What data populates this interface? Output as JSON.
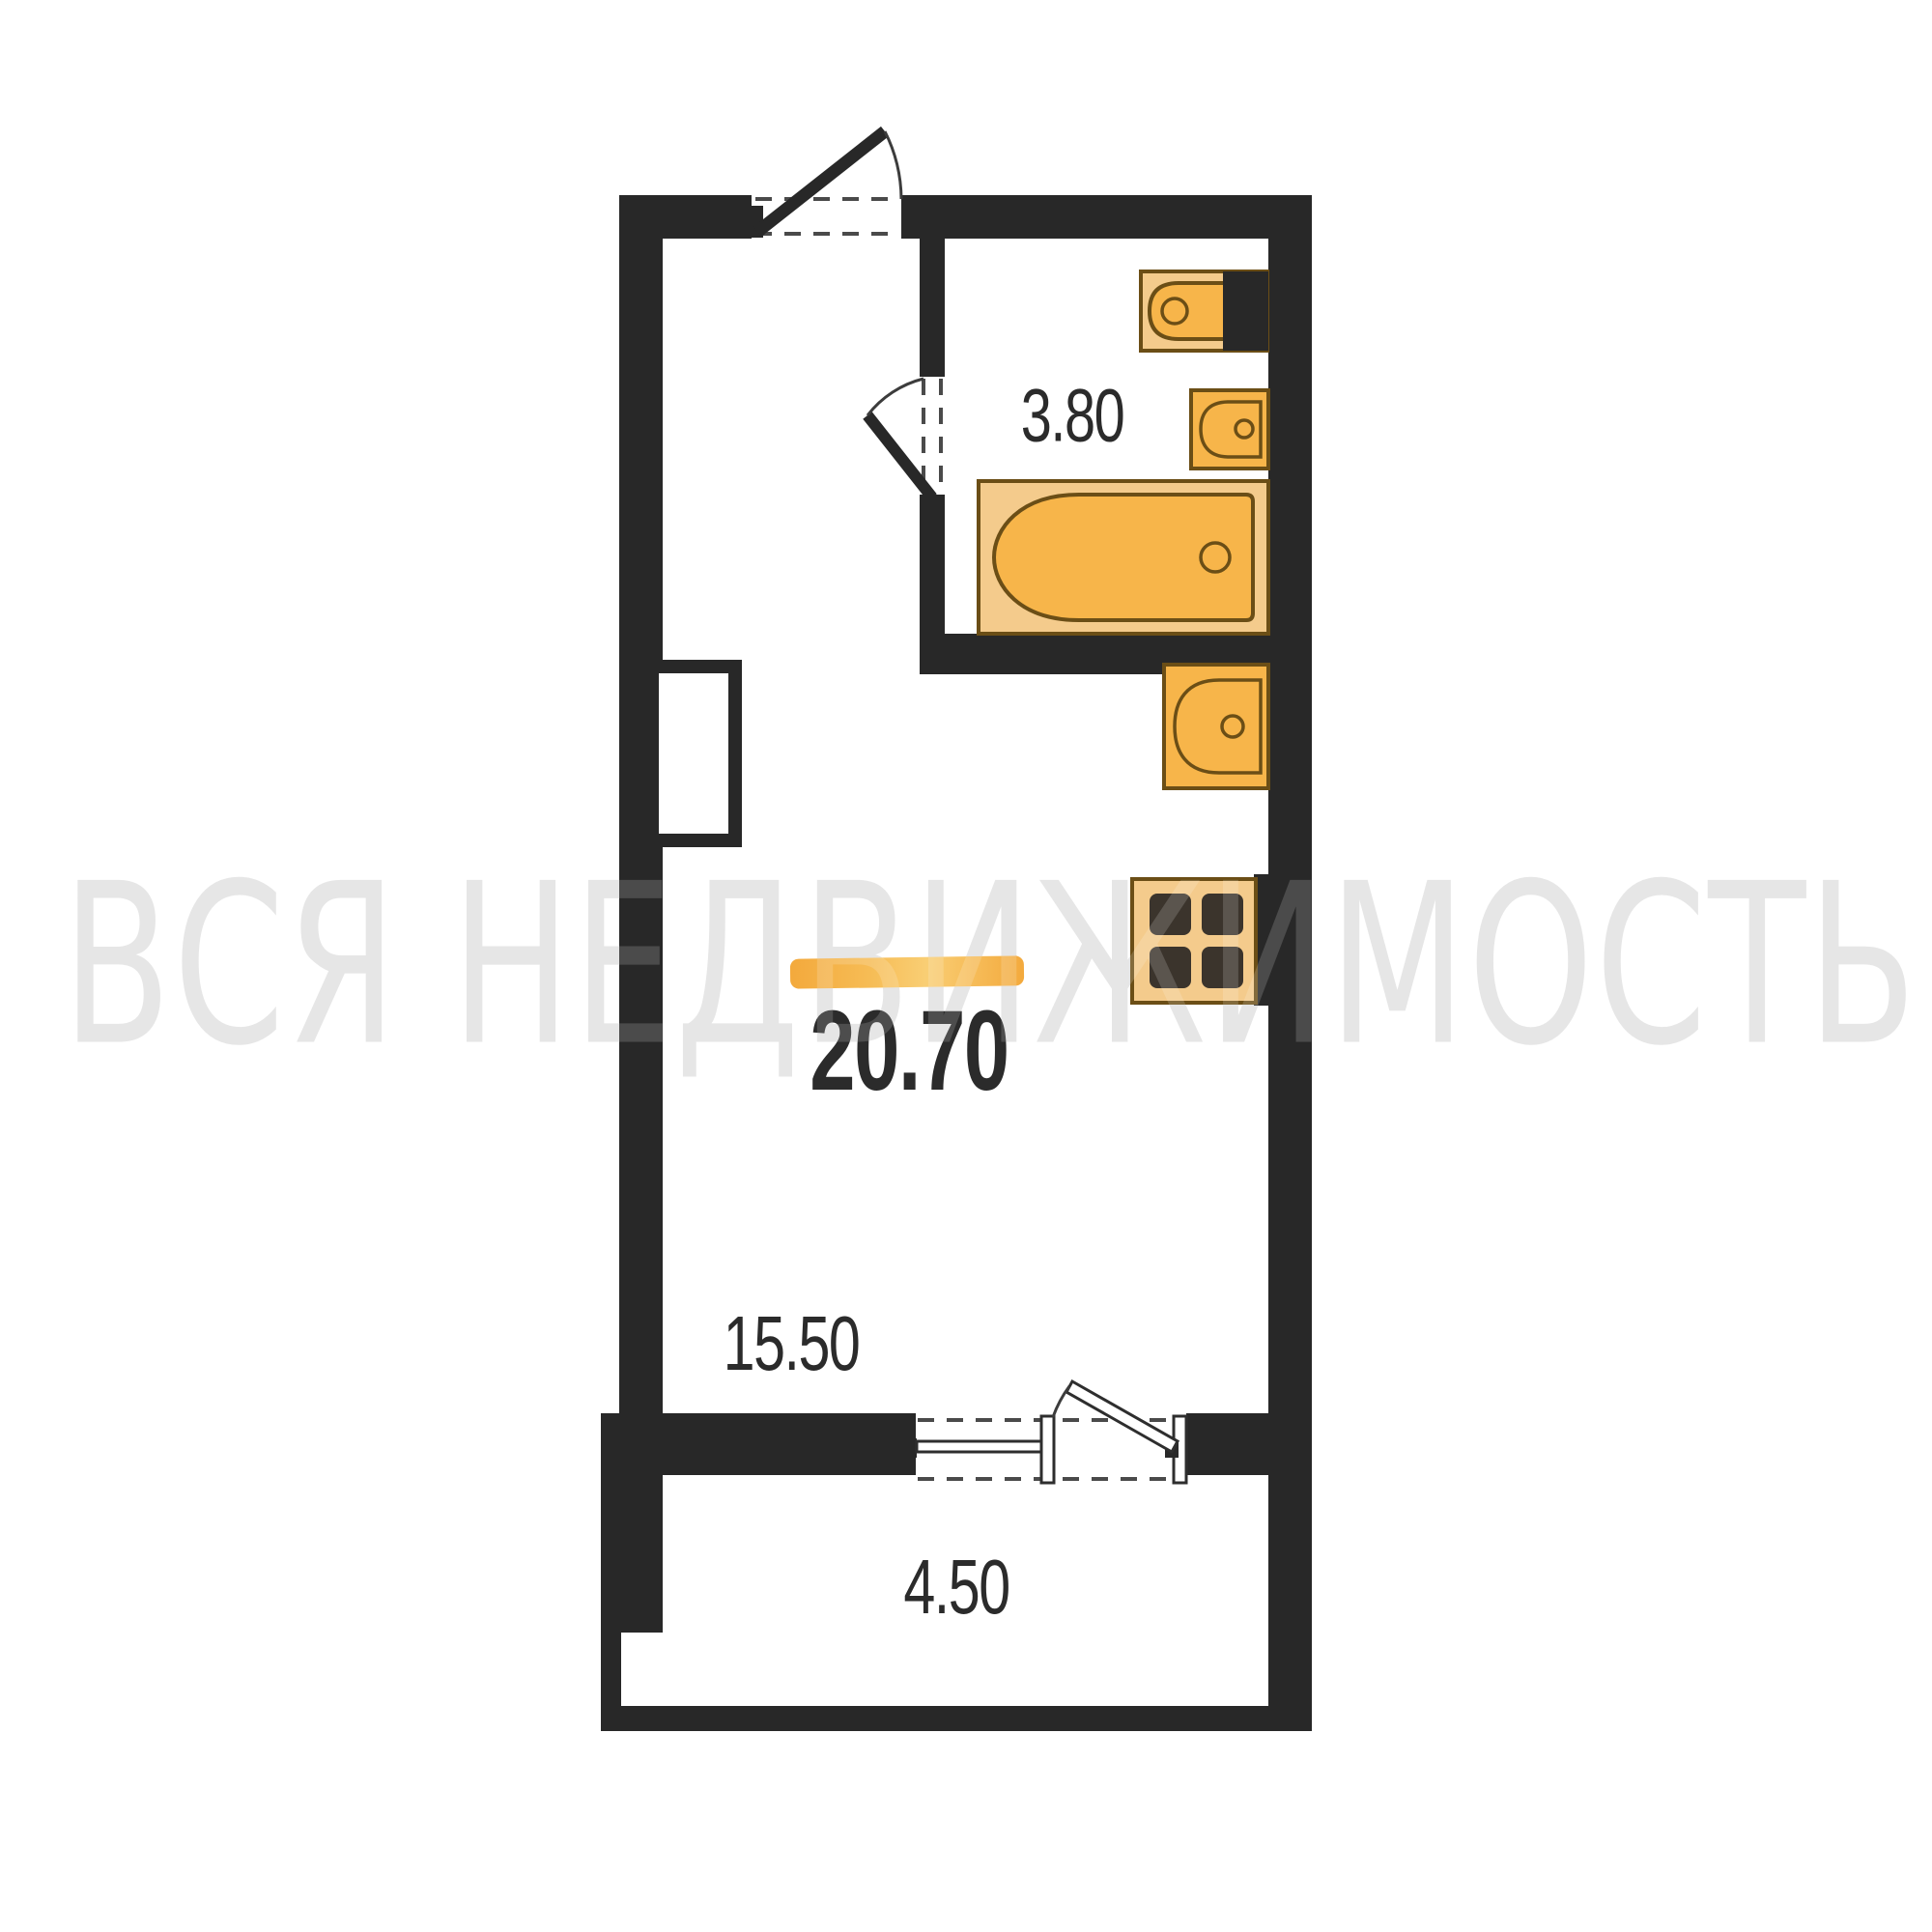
{
  "watermark": {
    "text": "ВСЯ НЕДВИЖИМОСТЬ"
  },
  "areas": {
    "total": "20.70",
    "bathroom": "3.80",
    "living": "15.50",
    "balcony": "4.50"
  },
  "icons": [
    "toilet-icon",
    "bathroom-sink-icon",
    "bathtub-icon",
    "kitchen-sink-icon",
    "stove-icon",
    "entrance-door-icon",
    "bathroom-door-icon",
    "balcony-door-icon",
    "balcony-window-icon",
    "wall-niche-icon"
  ],
  "colors": {
    "wall": "#282828",
    "dash": "#4a4a4a",
    "fixture_fill": "#F7B54A",
    "fixture_light": "#F4CB8C",
    "fixture_outline": "#6B4E16",
    "burner": "#3B342C",
    "highlight_a": "#F3A93C",
    "highlight_b": "#F6BC55",
    "highlight_c": "#F9CE74",
    "text": "#2B2B2B",
    "watermark": "#E2E2E2"
  }
}
